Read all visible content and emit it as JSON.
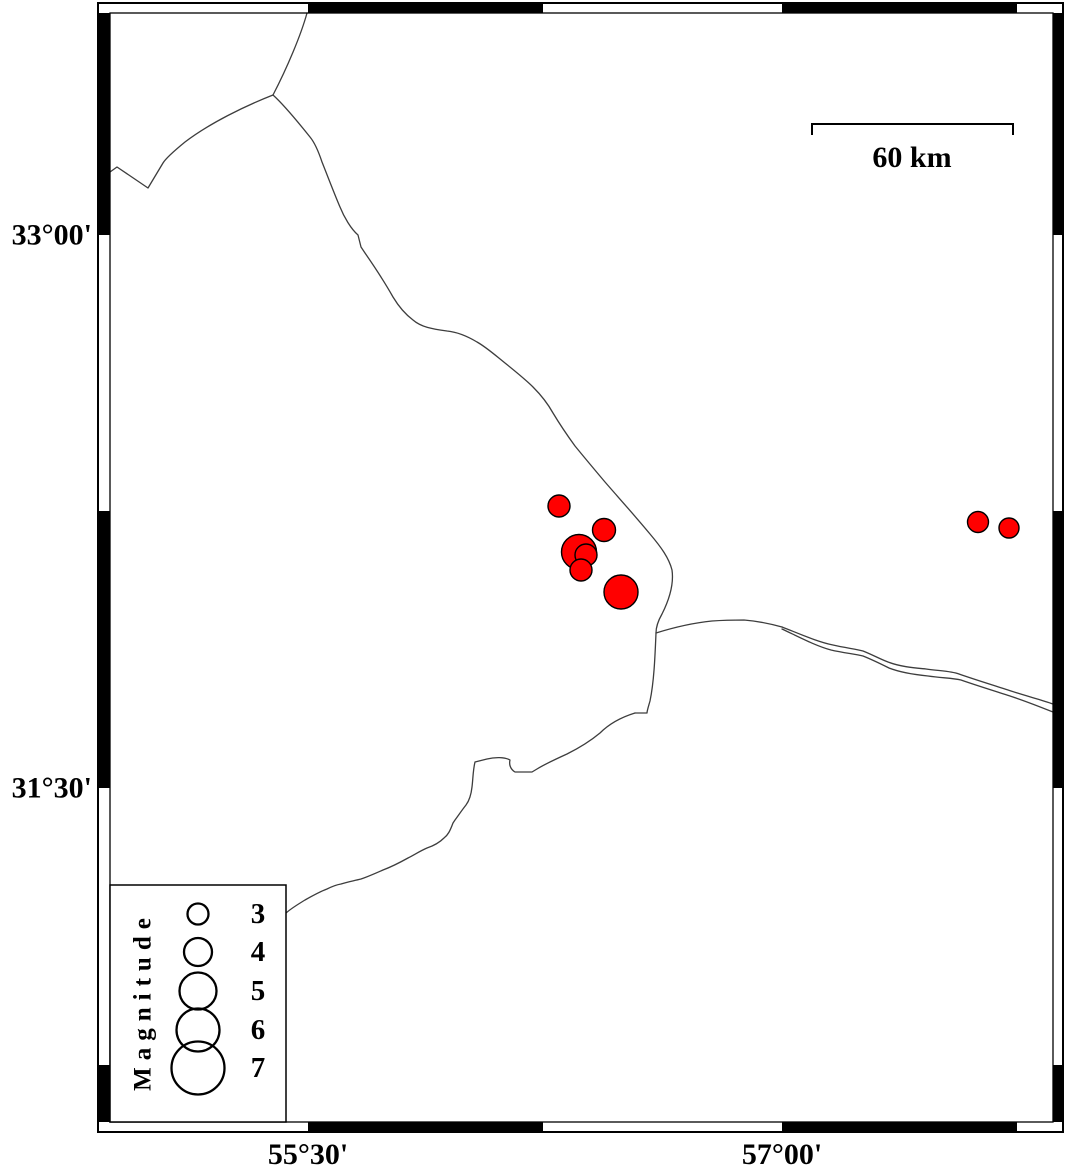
{
  "colors": {
    "background": "#ffffff",
    "epicenter_fill": "#ff0000",
    "epicenter_stroke": "#000000",
    "map_line": "#3d3d3d",
    "frame": "#000000",
    "text": "#000000"
  },
  "map": {
    "axis": {
      "left": [
        {
          "text": "33°00'",
          "y": 235
        },
        {
          "text": "31°30'",
          "y": 788
        }
      ],
      "bottom": [
        {
          "text": "55°30'",
          "x": 308
        },
        {
          "text": "57°00'",
          "x": 782
        }
      ]
    },
    "scale_bar": {
      "label": "60 km",
      "x1": 812,
      "x2": 1013,
      "y": 124,
      "tick_len": 11
    },
    "frame": {
      "outer": {
        "x": 98,
        "y": 3,
        "w": 965,
        "h": 1129
      },
      "inner": {
        "x": 110,
        "y": 13,
        "w": 943,
        "h": 1109
      },
      "top_black_segments": [
        [
          308,
          543
        ],
        [
          782,
          1017
        ]
      ],
      "bottom_black_segments": [
        [
          308,
          543
        ],
        [
          782,
          1017
        ]
      ],
      "left_black_segments": [
        [
          13,
          235
        ],
        [
          511,
          788
        ],
        [
          1065,
          1122
        ]
      ],
      "right_black_segments": [
        [
          13,
          235
        ],
        [
          511,
          788
        ],
        [
          1065,
          1122
        ]
      ]
    },
    "border_lines": [
      {
        "name": "boundary-north-entry",
        "path": "M307 13 C301 35 287 68 273 95"
      },
      {
        "name": "boundary-west-branch",
        "path": "M273 95 C245 106 210 123 185 142 C174 151 166 158 163 163 L148 188 L117 167 L110 172"
      },
      {
        "name": "boundary-main-diagonal",
        "path": "M273 95 C283 104 298 122 310 137 C315 143 319 153 322 162 C328 177 334 193 340 207 C344 217 351 229 358 235 L361 247 L365 253 C374 266 384 281 393 297 C399 307 405 314 413 320 C421 327 432 329 447 331 C457 332 467 336 477 342 C486 347 495 355 505 363 C515 371 525 379 533 387 C541 395 548 404 553 413 C559 423 567 435 575 446 C584 457 594 469 605 482 C618 497 636 517 650 534 C661 547 669 558 672 570 C674 584 669 600 662 614 C658 621 656 627 656 633 C655 657 654 682 650 701 C648 708 647 711 647 713 L635 713"
      },
      {
        "name": "boundary-southwest",
        "path": "M635 713 C622 717 610 723 600 733 C588 743 577 749 567 754 C556 759 545 764 537 769 L532 772 L515 772 C510 769 509 764 510 760 C505 757 495 757 487 759 L475 762 C473 770 473 779 472 787 C471 796 469 801 466 805 C462 810 458 816 455 820 L453 823 C450 831 448 835 444 838 C439 843 433 846 427 848 C420 851 414 855 408 858 C399 863 391 867 383 870 C374 874 367 877 361 879 C353 881 347 882 341 884 C335 885 331 887 327 889 C319 892 312 896 305 900 C297 905 290 909 285 914"
      },
      {
        "name": "road-single",
        "path": "M656 633 C672 628 692 623 712 621 C726 620 736 620 744 620 C757 621 771 624 782 627"
      },
      {
        "name": "road-upper",
        "path": "M782 627 C800 634 818 642 833 645 C846 648 856 649 863 651 C873 655 880 659 888 662 C901 667 916 668 926 669 C940 671 951 671 959 674 C976 680 996 686 1011 691 C1026 696 1042 700 1053 704"
      },
      {
        "name": "road-lower",
        "path": "M782 629 C799 637 816 646 831 650 C844 653 855 654 863 656 C873 660 881 664 889 668 C902 673 918 675 928 676 C942 678 953 678 961 680 C978 686 998 692 1013 697 C1028 702 1043 708 1053 712"
      }
    ]
  },
  "earthquakes": {
    "points": [
      {
        "x": 559,
        "y": 506,
        "r": 11
      },
      {
        "x": 604,
        "y": 530,
        "r": 11.5
      },
      {
        "x": 579,
        "y": 552,
        "r": 17.5
      },
      {
        "x": 586,
        "y": 555,
        "r": 11
      },
      {
        "x": 581,
        "y": 570,
        "r": 11
      },
      {
        "x": 621,
        "y": 592,
        "r": 17
      },
      {
        "x": 978,
        "y": 522,
        "r": 10.5
      },
      {
        "x": 1009,
        "y": 528,
        "r": 10
      }
    ]
  },
  "legend": {
    "title": "Magnitude",
    "box": {
      "x": 110,
      "y": 885,
      "w": 176,
      "h": 237
    },
    "circle_cx": 198,
    "label_x": 258,
    "entries": [
      {
        "label": "3",
        "cy": 914,
        "r": 10.5
      },
      {
        "label": "4",
        "cy": 952,
        "r": 14
      },
      {
        "label": "5",
        "cy": 991,
        "r": 18.5
      },
      {
        "label": "6",
        "cy": 1030,
        "r": 21.5
      },
      {
        "label": "7",
        "cy": 1068,
        "r": 26.5
      }
    ]
  }
}
